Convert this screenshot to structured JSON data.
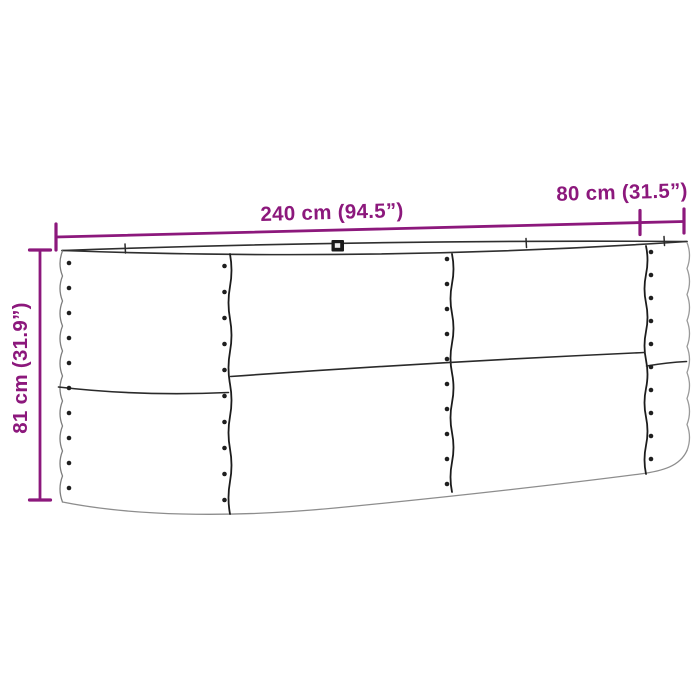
{
  "product_diagram": {
    "name": "metal-raised-garden-bed-dimension-diagram",
    "dimensions": {
      "length": {
        "value": "240 cm (94.5”)"
      },
      "depth": {
        "value": "80 cm (31.5”)"
      },
      "height": {
        "value": "81 cm (31.9”)"
      }
    },
    "colors": {
      "dimension_accent": "#8C187C",
      "outline_dark": "#232323",
      "outline_mid": "#3a3a3a",
      "silhouette_gray": "#8d8d8d",
      "background": "#ffffff"
    }
  }
}
